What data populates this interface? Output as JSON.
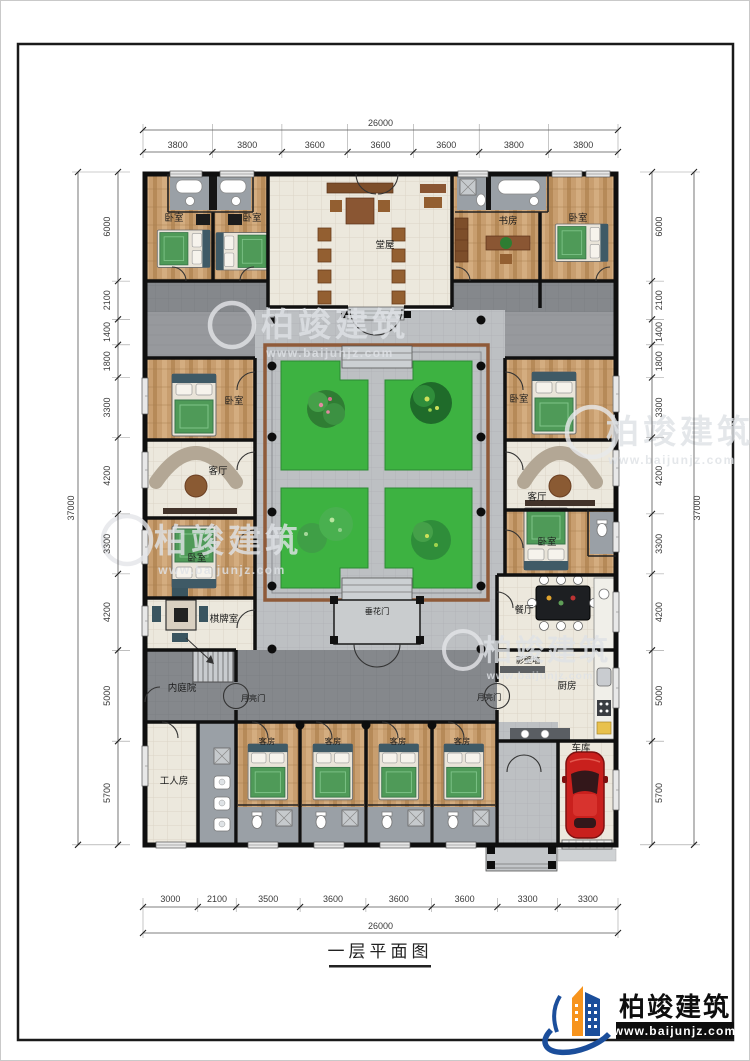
{
  "sheet": {
    "title": "一层平面图",
    "logo": {
      "company": "柏竣建筑",
      "website": "www.baijunjz.com"
    },
    "watermark": {
      "brand": "柏竣建筑",
      "site": "www.baijunjz.com"
    }
  },
  "dimensions": {
    "top": {
      "total": "26000",
      "segments": [
        "3800",
        "3800",
        "3600",
        "3600",
        "3600",
        "3800",
        "3800"
      ]
    },
    "bottom": {
      "total": "26000",
      "segments": [
        "3000",
        "2100",
        "3500",
        "3600",
        "3600",
        "3600",
        "3300",
        "3300"
      ]
    },
    "left": {
      "total": "37000",
      "segments": [
        "6000",
        "2100",
        "1400",
        "1800",
        "3300",
        "4200",
        "3300",
        "4200",
        "5000",
        "5700"
      ]
    },
    "right": {
      "total": "37000",
      "segments": [
        "6000",
        "2100",
        "1400",
        "1800",
        "3300",
        "4200",
        "3300",
        "4200",
        "5000",
        "5700"
      ]
    }
  },
  "rooms": {
    "bedroom": "卧室",
    "main_hall": "堂屋",
    "study": "书房",
    "living_room": "客厅",
    "chess_room": "棋牌室",
    "dining_room": "餐厅",
    "kitchen": "厨房",
    "screen_wall": "影壁墙",
    "inner_courtyard": "内庭院",
    "moon_gate": "月亮门",
    "flower_gate": "垂花门",
    "worker_room": "工人房",
    "guest_room": "客房",
    "garage": "车库"
  },
  "colors": {
    "lawn": "#3db241",
    "wood": "#c89e6f",
    "corridor": "#85888c",
    "walkway": "#bdc0c3",
    "railing": "#8f5a39",
    "car": "#c9201d",
    "logo_blue": "#1b4e9b",
    "logo_orange": "#f7941d"
  }
}
